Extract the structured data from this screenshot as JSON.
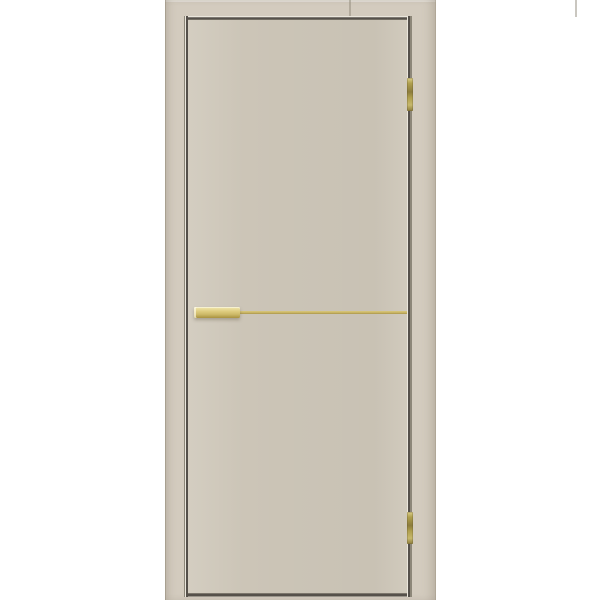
{
  "product": {
    "name": "interior-door",
    "description": "Beige matte flush slab interior door shown in its frame on a white background, hinged on the right with two brass hinges, a brass flush-pull handle on the left and a thin horizontal brass inlay strip across the middle of the leaf",
    "handle_type": "flush-pull",
    "hinge_count": 2
  },
  "colors": {
    "background": "#ffffff",
    "frame": "#d3cbbe",
    "door_leaf": "#cfc8ba",
    "gap_dark": "#55504a",
    "gap_mid": "#8d8779",
    "gap_light": "#eae6dc",
    "handle_gold": "#ddca7c",
    "handle_gold_light": "#f2e8b0",
    "handle_gold_dark": "#a8913f",
    "strip_gold": "#c9b463",
    "hinge_brass": "#b0a04e",
    "hinge_brass_dark": "#8c7c3c"
  }
}
